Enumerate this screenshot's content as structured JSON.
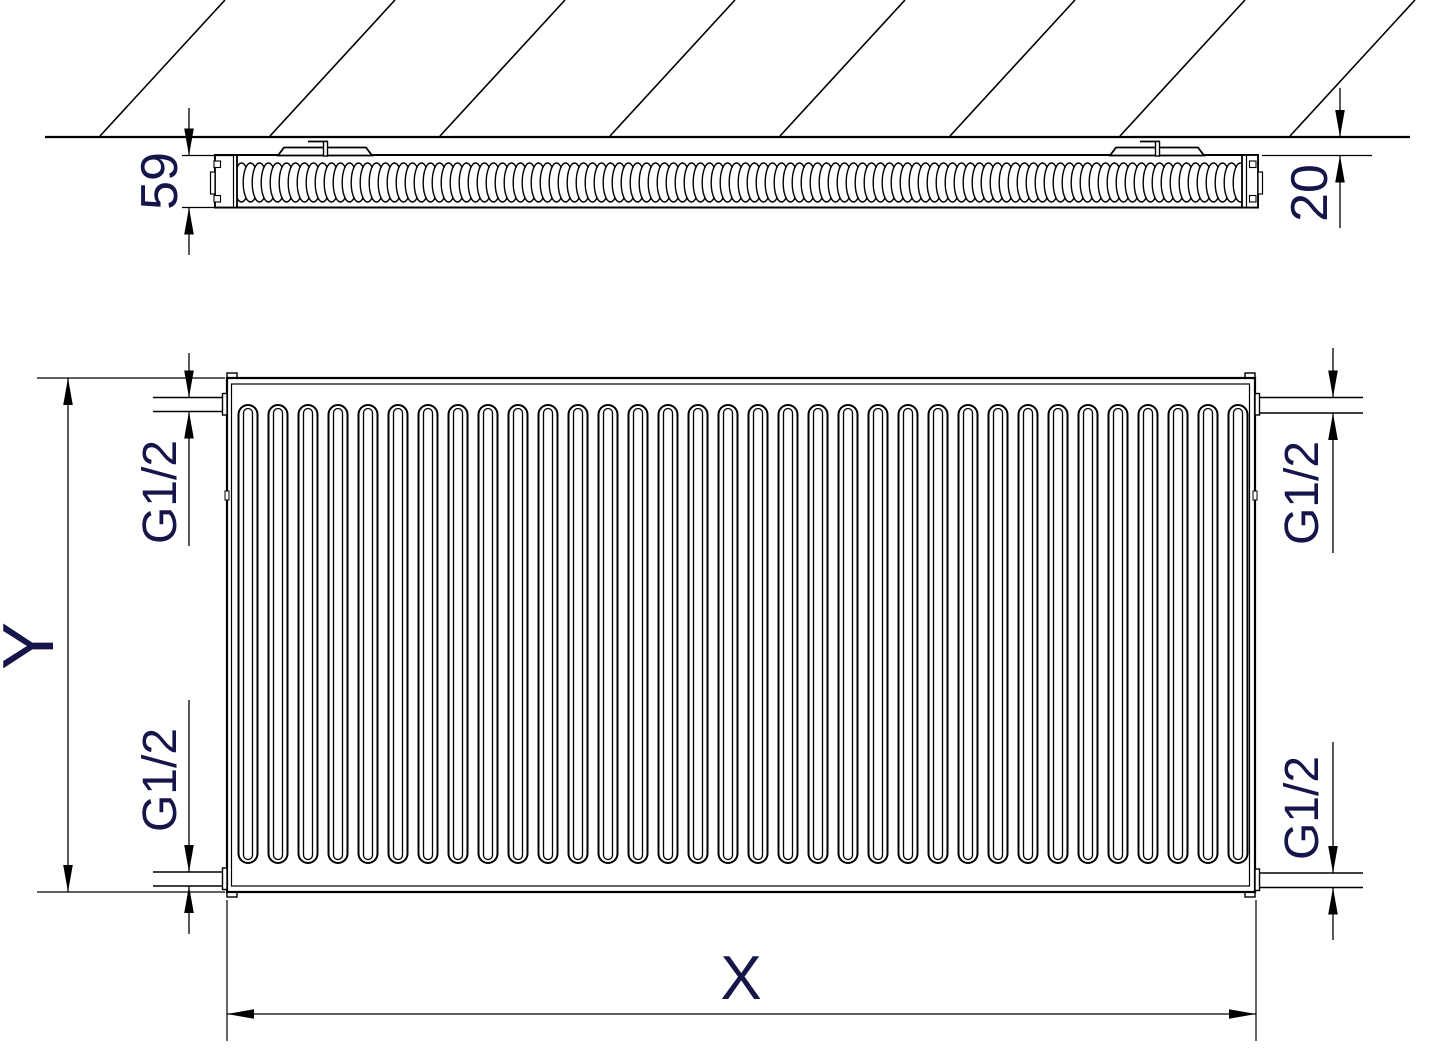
{
  "drawing": {
    "subject": "Panel radiator dimensional drawing",
    "views": {
      "top": "wall cross-section (plan view)",
      "front": "front elevation"
    },
    "colors": {
      "line_color": "#000000",
      "label_color": "#15154a",
      "background": "#ffffff"
    },
    "labels": {
      "depth": "59",
      "wall_distance": "20",
      "height": "Y",
      "width": "X",
      "conn_top_left": "G1/2",
      "conn_bottom_left": "G1/2",
      "conn_top_right": "G1/2",
      "conn_bottom_right": "G1/2"
    }
  }
}
